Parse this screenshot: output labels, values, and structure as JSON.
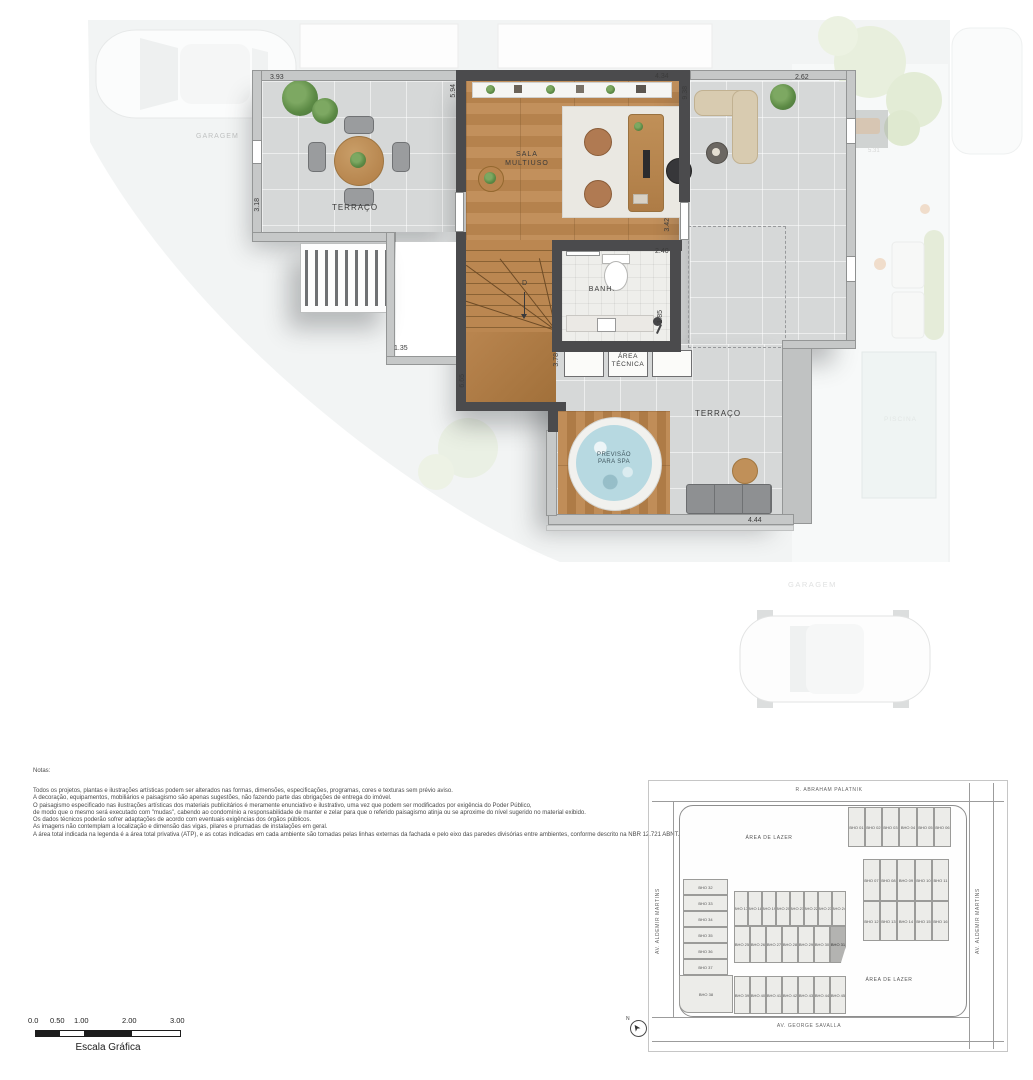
{
  "plan": {
    "rooms": {
      "terraco_left": "TERRAÇO",
      "sala_line1": "SALA",
      "sala_line2": "MULTIUSO",
      "banh": "BANH.",
      "area_tecnica_line1": "ÁREA",
      "area_tecnica_line2": "TÉCNICA",
      "terraco_right": "TERRAÇO",
      "spa_line1": "PREVISÃO",
      "spa_line2": "PARA SPA",
      "stair_direction": "D"
    },
    "dimensions": {
      "terrace_left_width": "3.93",
      "terrace_left_height": "3.18",
      "sala_left": "5.94",
      "sala_top": "4.34",
      "terrace_right_top": "2.62",
      "terrace_right_height": "9.38",
      "terrace_mid": "3.42",
      "banh_width": "2.40",
      "banh_height": "1.85",
      "area_tecnica_width": "3.78",
      "stair_height": "6.65",
      "void_width": "1.35",
      "spa_terrace_width": "4.44"
    },
    "context_labels": {
      "garagem_left": "GARAGEM",
      "garagem_bottom": "GARAGEM",
      "piscina": "PISCINA",
      "neighbor_dim": "5.31"
    }
  },
  "notes": {
    "title": "Notas:",
    "lines": [
      "Todos os projetos, plantas e ilustrações artísticas podem ser alterados nas formas, dimensões, especificações, programas, cores e texturas sem prévio aviso.",
      "A decoração, equipamentos, mobiliários e paisagismo são apenas sugestões, não fazendo parte das obrigações de entrega do imóvel.",
      "O paisagismo especificado nas ilustrações artísticas dos materiais publicitários é meramente enunciativo e ilustrativo, uma vez que podem ser modificados por exigência do Poder Público,",
      "de modo que o mesmo será executado com \"mudas\", cabendo ao condomínio a responsabilidade de manter e zelar para que o referido paisagismo atinja ou se aproxime do nível sugerido no material exibido.",
      "Os dados técnicos poderão sofrer adaptações de acordo com eventuais exigências dos órgãos públicos.",
      "As imagens não contemplam a localização e dimensão das vigas, pilares e prumadas de instalações em geral.",
      "A área total indicada na legenda é a área total privativa (ATP), e as cotas indicadas em cada ambiente são tomadas pelas linhas externas da fachada e pelo eixo das paredes divisórias entre ambientes, conforme descrito na NBR 12.721 ABNT."
    ]
  },
  "scale_bar": {
    "ticks": [
      "0.0",
      "0.50",
      "1.00",
      "2.00",
      "3.00"
    ],
    "label": "Escala Gráfica"
  },
  "site_plan": {
    "streets": {
      "top": "R. ABRAHAM PALATNIK",
      "left": "AV. ALDEMIR MARTINS",
      "right": "AV. ALDEMIR MARTINS",
      "bottom": "AV. GEORGE SAVALLA"
    },
    "leisure_top": "ÁREA DE LAZER",
    "leisure_bottom": "ÁREA DE LAZER",
    "north_label": "N",
    "highlighted_unit": "BHO 31",
    "units": [
      "BHO 01",
      "BHO 02",
      "BHO 03",
      "BHO 04",
      "BHO 05",
      "BHO 06",
      "BHO 07",
      "BHO 08",
      "BHO 09",
      "BHO 10",
      "BHO 11",
      "BHO 12",
      "BHO 13",
      "BHO 14",
      "BHO 15",
      "BHO 16",
      "BHO 17",
      "BHO 18",
      "BHO 19",
      "BHO 20",
      "BHO 21",
      "BHO 22",
      "BHO 23",
      "BHO 24",
      "BHO 25",
      "BHO 26",
      "BHO 27",
      "BHO 28",
      "BHO 29",
      "BHO 30",
      "BHO 31",
      "BHO 32",
      "BHO 33",
      "BHO 34",
      "BHO 35",
      "BHO 36",
      "BHO 37",
      "BHO 38",
      "BHO 39",
      "BHO 40",
      "BHO 41",
      "BHO 42",
      "BHO 43",
      "BHO 44",
      "BHO 45"
    ]
  },
  "colors": {
    "wall_dark": "#4b4b4d",
    "wall_light": "#c6c8c8",
    "wood": "#b9854f",
    "concrete": "#d6d8d8",
    "spa_water": "#b7d9e1",
    "highlighted_unit_fill": "#b3b3b1"
  }
}
